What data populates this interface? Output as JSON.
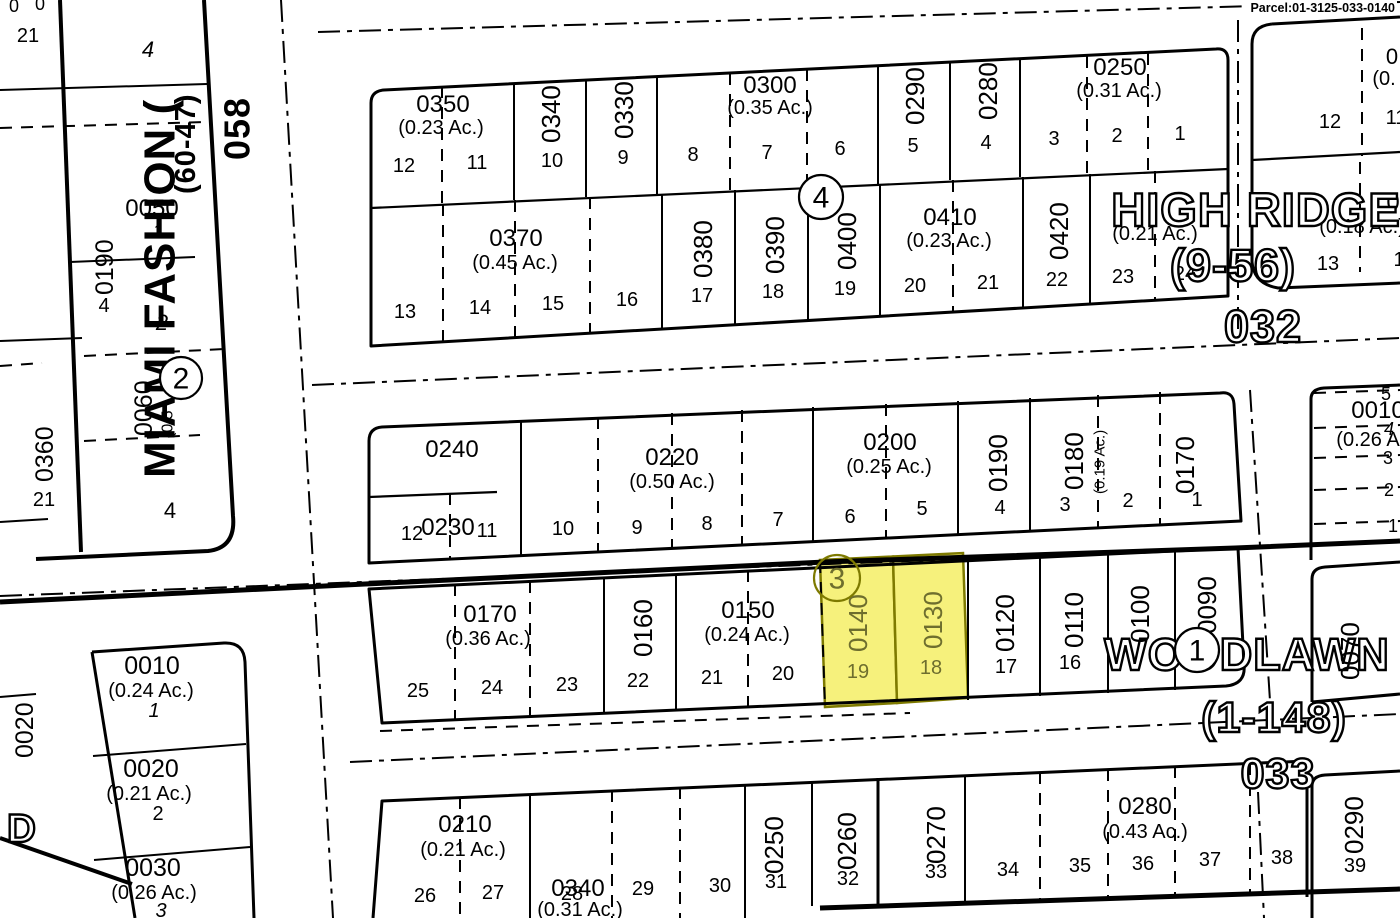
{
  "header": {
    "parcel_label": "Parcel:01-3125-033-0140"
  },
  "colors": {
    "background": "#ffffff",
    "ink": "#000000",
    "highlight_fill": "#f6f17c",
    "highlight_stroke": "#7e7a00",
    "highlight_text": "#6e6e2e"
  },
  "highlighted_parcels": [
    {
      "parcel": "0140",
      "lot": "19"
    },
    {
      "parcel": "0130",
      "lot": "18"
    }
  ],
  "plat_names": {
    "west": [
      "MIAMI FASHION (",
      "(60-47)",
      "058"
    ],
    "northeast": [
      "HIGH RIDGE",
      "(9-56)",
      "032"
    ],
    "southeast": [
      "WOODLAWN T",
      "(1-148)",
      "033"
    ]
  },
  "circled_block_numbers": [
    {
      "n": "4",
      "x": 821,
      "y": 197,
      "r": 22,
      "hl": false
    },
    {
      "n": "2",
      "x": 181,
      "y": 378,
      "r": 21,
      "hl": false
    },
    {
      "n": "3",
      "x": 837,
      "y": 578,
      "r": 23,
      "hl": true
    },
    {
      "n": "1",
      "x": 1197,
      "y": 650,
      "r": 22,
      "hl": false
    }
  ],
  "texts": [
    {
      "t": "0",
      "x": 14,
      "y": 12,
      "s": 18,
      "k": "lot"
    },
    {
      "t": "0",
      "x": 40,
      "y": 10,
      "s": 18,
      "k": "lot"
    },
    {
      "t": "21",
      "x": 28,
      "y": 42,
      "s": 20,
      "k": "lot"
    },
    {
      "t": "4",
      "x": 148,
      "y": 57,
      "s": 22,
      "k": "lot",
      "it": 1
    },
    {
      "t": "MIAMI FASHION (",
      "x": 160,
      "y": 478,
      "s": 44,
      "r": -90,
      "k": "ps"
    },
    {
      "t": "(60-47)",
      "x": 186,
      "y": 194,
      "s": 29,
      "r": -90,
      "k": "ps"
    },
    {
      "t": "058",
      "x": 237,
      "y": 160,
      "s": 36,
      "r": -90,
      "k": "ps"
    },
    {
      "t": "0050",
      "x": 152,
      "y": 216,
      "s": 24,
      "k": "pn"
    },
    {
      "t": "1",
      "x": 158,
      "y": 238,
      "s": 20,
      "k": "lot",
      "it": 1
    },
    {
      "t": "0190",
      "x": 105,
      "y": 295,
      "s": 25,
      "r": -90,
      "k": "pn"
    },
    {
      "t": "4",
      "x": 104,
      "y": 312,
      "s": 20,
      "k": "lot"
    },
    {
      "t": "2",
      "x": 162,
      "y": 330,
      "s": 22,
      "k": "lot",
      "it": 1
    },
    {
      "t": "0360",
      "x": 45,
      "y": 482,
      "s": 25,
      "r": -90,
      "k": "pn"
    },
    {
      "t": "21",
      "x": 44,
      "y": 506,
      "s": 20,
      "k": "lot"
    },
    {
      "t": "0060",
      "x": 144,
      "y": 436,
      "s": 25,
      "r": -90,
      "k": "pn"
    },
    {
      "t": "(0.5",
      "x": 168,
      "y": 438,
      "s": 16,
      "r": -90,
      "k": "ac"
    },
    {
      "t": "4",
      "x": 170,
      "y": 518,
      "s": 22,
      "k": "lot"
    },
    {
      "t": "0020",
      "x": 25,
      "y": 758,
      "s": 25,
      "r": -90,
      "k": "pn"
    },
    {
      "t": "D",
      "x": 22,
      "y": 842,
      "s": 40,
      "k": "plat"
    },
    {
      "t": "0010",
      "x": 152,
      "y": 674,
      "s": 25,
      "k": "pn"
    },
    {
      "t": "(0.24 Ac.)",
      "x": 151,
      "y": 697,
      "s": 20,
      "k": "ac"
    },
    {
      "t": "1",
      "x": 154,
      "y": 717,
      "s": 20,
      "k": "lot",
      "it": 1
    },
    {
      "t": "0020",
      "x": 151,
      "y": 777,
      "s": 25,
      "k": "pn"
    },
    {
      "t": "(0.21 Ac.)",
      "x": 149,
      "y": 800,
      "s": 20,
      "k": "ac"
    },
    {
      "t": "2",
      "x": 158,
      "y": 820,
      "s": 20,
      "k": "lot"
    },
    {
      "t": "0030",
      "x": 153,
      "y": 876,
      "s": 25,
      "k": "pn"
    },
    {
      "t": "(0.26 Ac.)",
      "x": 154,
      "y": 899,
      "s": 20,
      "k": "ac"
    },
    {
      "t": "3",
      "x": 161,
      "y": 917,
      "s": 20,
      "k": "lot",
      "it": 1
    },
    {
      "t": "0350",
      "x": 443,
      "y": 112,
      "s": 24,
      "k": "pn"
    },
    {
      "t": "(0.23 Ac.)",
      "x": 441,
      "y": 134,
      "s": 20,
      "k": "ac"
    },
    {
      "t": "0340",
      "x": 551,
      "y": 143,
      "s": 26,
      "r": -90,
      "k": "pn"
    },
    {
      "t": "0330",
      "x": 624,
      "y": 139,
      "s": 26,
      "r": -90,
      "k": "pn"
    },
    {
      "t": "0300",
      "x": 770,
      "y": 93,
      "s": 24,
      "k": "pn"
    },
    {
      "t": "(0.35 Ac.)",
      "x": 770,
      "y": 114,
      "s": 20,
      "k": "ac"
    },
    {
      "t": "0290",
      "x": 915,
      "y": 125,
      "s": 26,
      "r": -90,
      "k": "pn"
    },
    {
      "t": "0280",
      "x": 988,
      "y": 120,
      "s": 26,
      "r": -90,
      "k": "pn"
    },
    {
      "t": "0250",
      "x": 1120,
      "y": 75,
      "s": 24,
      "k": "pn"
    },
    {
      "t": "(0.31 Ac.)",
      "x": 1119,
      "y": 97,
      "s": 20,
      "k": "ac"
    },
    {
      "t": "12",
      "x": 404,
      "y": 172,
      "s": 20,
      "k": "lot"
    },
    {
      "t": "11",
      "x": 477,
      "y": 169,
      "s": 20,
      "k": "lot"
    },
    {
      "t": "10",
      "x": 552,
      "y": 167,
      "s": 20,
      "k": "lot"
    },
    {
      "t": "9",
      "x": 623,
      "y": 164,
      "s": 20,
      "k": "lot"
    },
    {
      "t": "8",
      "x": 693,
      "y": 161,
      "s": 20,
      "k": "lot"
    },
    {
      "t": "7",
      "x": 767,
      "y": 159,
      "s": 20,
      "k": "lot"
    },
    {
      "t": "6",
      "x": 840,
      "y": 155,
      "s": 20,
      "k": "lot"
    },
    {
      "t": "5",
      "x": 913,
      "y": 152,
      "s": 20,
      "k": "lot"
    },
    {
      "t": "4",
      "x": 986,
      "y": 149,
      "s": 20,
      "k": "lot"
    },
    {
      "t": "3",
      "x": 1054,
      "y": 145,
      "s": 20,
      "k": "lot"
    },
    {
      "t": "2",
      "x": 1117,
      "y": 142,
      "s": 20,
      "k": "lot"
    },
    {
      "t": "1",
      "x": 1180,
      "y": 140,
      "s": 20,
      "k": "lot"
    },
    {
      "t": "0370",
      "x": 516,
      "y": 246,
      "s": 24,
      "k": "pn"
    },
    {
      "t": "(0.45 Ac.)",
      "x": 515,
      "y": 269,
      "s": 20,
      "k": "ac"
    },
    {
      "t": "0380",
      "x": 703,
      "y": 278,
      "s": 26,
      "r": -90,
      "k": "pn"
    },
    {
      "t": "0390",
      "x": 775,
      "y": 274,
      "s": 26,
      "r": -90,
      "k": "pn"
    },
    {
      "t": "0400",
      "x": 847,
      "y": 270,
      "s": 26,
      "r": -90,
      "k": "pn"
    },
    {
      "t": "0410",
      "x": 950,
      "y": 225,
      "s": 24,
      "k": "pn"
    },
    {
      "t": "(0.23 Ac.)",
      "x": 949,
      "y": 247,
      "s": 20,
      "k": "ac"
    },
    {
      "t": "0420",
      "x": 1059,
      "y": 260,
      "s": 26,
      "r": -90,
      "k": "pn"
    },
    {
      "t": "(0.21 Ac.)",
      "x": 1155,
      "y": 240,
      "s": 20,
      "k": "ac"
    },
    {
      "t": "13",
      "x": 405,
      "y": 318,
      "s": 20,
      "k": "lot"
    },
    {
      "t": "14",
      "x": 480,
      "y": 314,
      "s": 20,
      "k": "lot"
    },
    {
      "t": "15",
      "x": 553,
      "y": 310,
      "s": 20,
      "k": "lot"
    },
    {
      "t": "16",
      "x": 627,
      "y": 306,
      "s": 20,
      "k": "lot"
    },
    {
      "t": "17",
      "x": 702,
      "y": 302,
      "s": 20,
      "k": "lot"
    },
    {
      "t": "18",
      "x": 773,
      "y": 298,
      "s": 20,
      "k": "lot"
    },
    {
      "t": "19",
      "x": 845,
      "y": 295,
      "s": 20,
      "k": "lot"
    },
    {
      "t": "20",
      "x": 915,
      "y": 292,
      "s": 20,
      "k": "lot"
    },
    {
      "t": "21",
      "x": 988,
      "y": 289,
      "s": 20,
      "k": "lot"
    },
    {
      "t": "22",
      "x": 1057,
      "y": 286,
      "s": 20,
      "k": "lot"
    },
    {
      "t": "23",
      "x": 1123,
      "y": 283,
      "s": 20,
      "k": "lot"
    },
    {
      "t": "24",
      "x": 1185,
      "y": 280,
      "s": 20,
      "k": "lot"
    },
    {
      "t": "0",
      "x": 1392,
      "y": 64,
      "s": 22,
      "k": "pn"
    },
    {
      "t": "(0.",
      "x": 1384,
      "y": 85,
      "s": 20,
      "k": "ac"
    },
    {
      "t": "12",
      "x": 1330,
      "y": 128,
      "s": 20,
      "k": "lot"
    },
    {
      "t": "11",
      "x": 1396,
      "y": 124,
      "s": 20,
      "k": "lot"
    },
    {
      "t": "0",
      "x": 1393,
      "y": 210,
      "s": 24,
      "k": "pn"
    },
    {
      "t": "(0.18 Ac.)",
      "x": 1362,
      "y": 233,
      "s": 20,
      "k": "ac"
    },
    {
      "t": "13",
      "x": 1328,
      "y": 270,
      "s": 20,
      "k": "lot"
    },
    {
      "t": "1",
      "x": 1399,
      "y": 266,
      "s": 20,
      "k": "lot"
    },
    {
      "t": "HIGH RIDGE",
      "x": 1256,
      "y": 226,
      "s": 47,
      "k": "plat"
    },
    {
      "t": "(9-56)",
      "x": 1233,
      "y": 281,
      "s": 45,
      "k": "plat"
    },
    {
      "t": "032",
      "x": 1263,
      "y": 342,
      "s": 45,
      "k": "plat"
    },
    {
      "t": "WOODLAWN T",
      "x": 1268,
      "y": 670,
      "s": 45,
      "k": "plat"
    },
    {
      "t": "(1-148)",
      "x": 1274,
      "y": 732,
      "s": 43,
      "k": "plat"
    },
    {
      "t": "033",
      "x": 1278,
      "y": 788,
      "s": 43,
      "k": "plat"
    },
    {
      "t": "0240",
      "x": 452,
      "y": 457,
      "s": 24,
      "k": "pn"
    },
    {
      "t": "0230",
      "x": 448,
      "y": 535,
      "s": 24,
      "k": "pn"
    },
    {
      "t": "12",
      "x": 412,
      "y": 540,
      "s": 20,
      "k": "lot"
    },
    {
      "t": "11",
      "x": 487,
      "y": 537,
      "s": 20,
      "k": "lot"
    },
    {
      "t": "10",
      "x": 563,
      "y": 535,
      "s": 20,
      "k": "lot"
    },
    {
      "t": "0220",
      "x": 672,
      "y": 465,
      "s": 24,
      "k": "pn"
    },
    {
      "t": "(0.50 Ac.)",
      "x": 672,
      "y": 488,
      "s": 20,
      "k": "ac"
    },
    {
      "t": "9",
      "x": 637,
      "y": 534,
      "s": 20,
      "k": "lot"
    },
    {
      "t": "8",
      "x": 707,
      "y": 530,
      "s": 20,
      "k": "lot"
    },
    {
      "t": "7",
      "x": 778,
      "y": 526,
      "s": 20,
      "k": "lot"
    },
    {
      "t": "6",
      "x": 850,
      "y": 523,
      "s": 20,
      "k": "lot"
    },
    {
      "t": "0200",
      "x": 890,
      "y": 450,
      "s": 24,
      "k": "pn"
    },
    {
      "t": "(0.25 Ac.)",
      "x": 889,
      "y": 473,
      "s": 20,
      "k": "ac"
    },
    {
      "t": "5",
      "x": 922,
      "y": 515,
      "s": 20,
      "k": "lot"
    },
    {
      "t": "0190",
      "x": 998,
      "y": 492,
      "s": 26,
      "r": -90,
      "k": "pn"
    },
    {
      "t": "4",
      "x": 1000,
      "y": 514,
      "s": 20,
      "k": "lot"
    },
    {
      "t": "0180",
      "x": 1074,
      "y": 490,
      "s": 26,
      "r": -90,
      "k": "pn"
    },
    {
      "t": "(0.19 Ac.)",
      "x": 1100,
      "y": 494,
      "s": 15,
      "r": -90,
      "k": "ac"
    },
    {
      "t": "3",
      "x": 1065,
      "y": 511,
      "s": 20,
      "k": "lot"
    },
    {
      "t": "2",
      "x": 1128,
      "y": 507,
      "s": 20,
      "k": "lot"
    },
    {
      "t": "0170",
      "x": 1185,
      "y": 494,
      "s": 26,
      "r": -90,
      "k": "pn"
    },
    {
      "t": "1",
      "x": 1197,
      "y": 506,
      "s": 20,
      "k": "lot"
    },
    {
      "t": "5",
      "x": 1386,
      "y": 400,
      "s": 18,
      "k": "lot"
    },
    {
      "t": "0010",
      "x": 1378,
      "y": 418,
      "s": 24,
      "k": "pn"
    },
    {
      "t": "4",
      "x": 1389,
      "y": 435,
      "s": 18,
      "k": "lot",
      "it": 1
    },
    {
      "t": "(0.26 A",
      "x": 1368,
      "y": 446,
      "s": 20,
      "k": "ac"
    },
    {
      "t": "3",
      "x": 1388,
      "y": 464,
      "s": 18,
      "k": "lot"
    },
    {
      "t": "2",
      "x": 1389,
      "y": 496,
      "s": 18,
      "k": "lot"
    },
    {
      "t": "1",
      "x": 1393,
      "y": 532,
      "s": 18,
      "k": "lot"
    },
    {
      "t": "25",
      "x": 418,
      "y": 697,
      "s": 20,
      "k": "lot"
    },
    {
      "t": "24",
      "x": 492,
      "y": 694,
      "s": 20,
      "k": "lot"
    },
    {
      "t": "0170",
      "x": 490,
      "y": 622,
      "s": 24,
      "k": "pn"
    },
    {
      "t": "(0.36 Ac.)",
      "x": 488,
      "y": 645,
      "s": 20,
      "k": "ac"
    },
    {
      "t": "23",
      "x": 567,
      "y": 691,
      "s": 20,
      "k": "lot"
    },
    {
      "t": "0160",
      "x": 643,
      "y": 657,
      "s": 26,
      "r": -90,
      "k": "pn"
    },
    {
      "t": "22",
      "x": 638,
      "y": 687,
      "s": 20,
      "k": "lot"
    },
    {
      "t": "0150",
      "x": 748,
      "y": 618,
      "s": 24,
      "k": "pn"
    },
    {
      "t": "(0.24 Ac.)",
      "x": 747,
      "y": 641,
      "s": 20,
      "k": "ac"
    },
    {
      "t": "21",
      "x": 712,
      "y": 684,
      "s": 20,
      "k": "lot"
    },
    {
      "t": "20",
      "x": 783,
      "y": 680,
      "s": 20,
      "k": "lot"
    },
    {
      "t": "0140",
      "x": 858,
      "y": 652,
      "s": 26,
      "r": -90,
      "k": "hl"
    },
    {
      "t": "19",
      "x": 858,
      "y": 678,
      "s": 20,
      "k": "hl"
    },
    {
      "t": "0130",
      "x": 933,
      "y": 649,
      "s": 26,
      "r": -90,
      "k": "hl"
    },
    {
      "t": "18",
      "x": 931,
      "y": 674,
      "s": 20,
      "k": "hl"
    },
    {
      "t": "0120",
      "x": 1005,
      "y": 652,
      "s": 26,
      "r": -90,
      "k": "pn"
    },
    {
      "t": "17",
      "x": 1006,
      "y": 673,
      "s": 20,
      "k": "lot"
    },
    {
      "t": "0110",
      "x": 1074,
      "y": 648,
      "s": 26,
      "r": -90,
      "k": "pn"
    },
    {
      "t": "16",
      "x": 1070,
      "y": 669,
      "s": 20,
      "k": "lot"
    },
    {
      "t": "0100",
      "x": 1140,
      "y": 643,
      "s": 26,
      "r": -90,
      "k": "pn"
    },
    {
      "t": "0090",
      "x": 1207,
      "y": 634,
      "s": 26,
      "r": -90,
      "k": "pn"
    },
    {
      "t": "0070",
      "x": 1350,
      "y": 680,
      "s": 26,
      "r": -90,
      "k": "pn"
    },
    {
      "t": "0290",
      "x": 1354,
      "y": 854,
      "s": 26,
      "r": -90,
      "k": "pn"
    },
    {
      "t": "39",
      "x": 1355,
      "y": 872,
      "s": 20,
      "k": "lot"
    },
    {
      "t": "0210",
      "x": 465,
      "y": 832,
      "s": 24,
      "k": "pn"
    },
    {
      "t": "(0.21 Ac.)",
      "x": 463,
      "y": 856,
      "s": 20,
      "k": "ac"
    },
    {
      "t": "26",
      "x": 425,
      "y": 902,
      "s": 20,
      "k": "lot"
    },
    {
      "t": "27",
      "x": 493,
      "y": 899,
      "s": 20,
      "k": "lot"
    },
    {
      "t": "0340",
      "x": 578,
      "y": 896,
      "s": 24,
      "k": "pn"
    },
    {
      "t": "28",
      "x": 572,
      "y": 900,
      "s": 20,
      "k": "lot"
    },
    {
      "t": "(0.31 Ac.)",
      "x": 580,
      "y": 916,
      "s": 20,
      "k": "ac"
    },
    {
      "t": "29",
      "x": 643,
      "y": 895,
      "s": 20,
      "k": "lot"
    },
    {
      "t": "30",
      "x": 720,
      "y": 892,
      "s": 20,
      "k": "lot"
    },
    {
      "t": "0250",
      "x": 774,
      "y": 874,
      "s": 26,
      "r": -90,
      "k": "pn"
    },
    {
      "t": "31",
      "x": 776,
      "y": 888,
      "s": 20,
      "k": "lot"
    },
    {
      "t": "0260",
      "x": 847,
      "y": 870,
      "s": 26,
      "r": -90,
      "k": "pn"
    },
    {
      "t": "32",
      "x": 848,
      "y": 885,
      "s": 20,
      "k": "lot"
    },
    {
      "t": "0270",
      "x": 936,
      "y": 864,
      "s": 26,
      "r": -90,
      "k": "pn"
    },
    {
      "t": "33",
      "x": 936,
      "y": 878,
      "s": 20,
      "k": "lot"
    },
    {
      "t": "34",
      "x": 1008,
      "y": 876,
      "s": 20,
      "k": "lot"
    },
    {
      "t": "35",
      "x": 1080,
      "y": 872,
      "s": 20,
      "k": "lot"
    },
    {
      "t": "0280",
      "x": 1145,
      "y": 814,
      "s": 24,
      "k": "pn"
    },
    {
      "t": "(0.43 Ac.)",
      "x": 1145,
      "y": 838,
      "s": 20,
      "k": "ac"
    },
    {
      "t": "36",
      "x": 1143,
      "y": 870,
      "s": 20,
      "k": "lot"
    },
    {
      "t": "37",
      "x": 1210,
      "y": 866,
      "s": 20,
      "k": "lot"
    },
    {
      "t": "38",
      "x": 1282,
      "y": 864,
      "s": 20,
      "k": "lot"
    }
  ]
}
